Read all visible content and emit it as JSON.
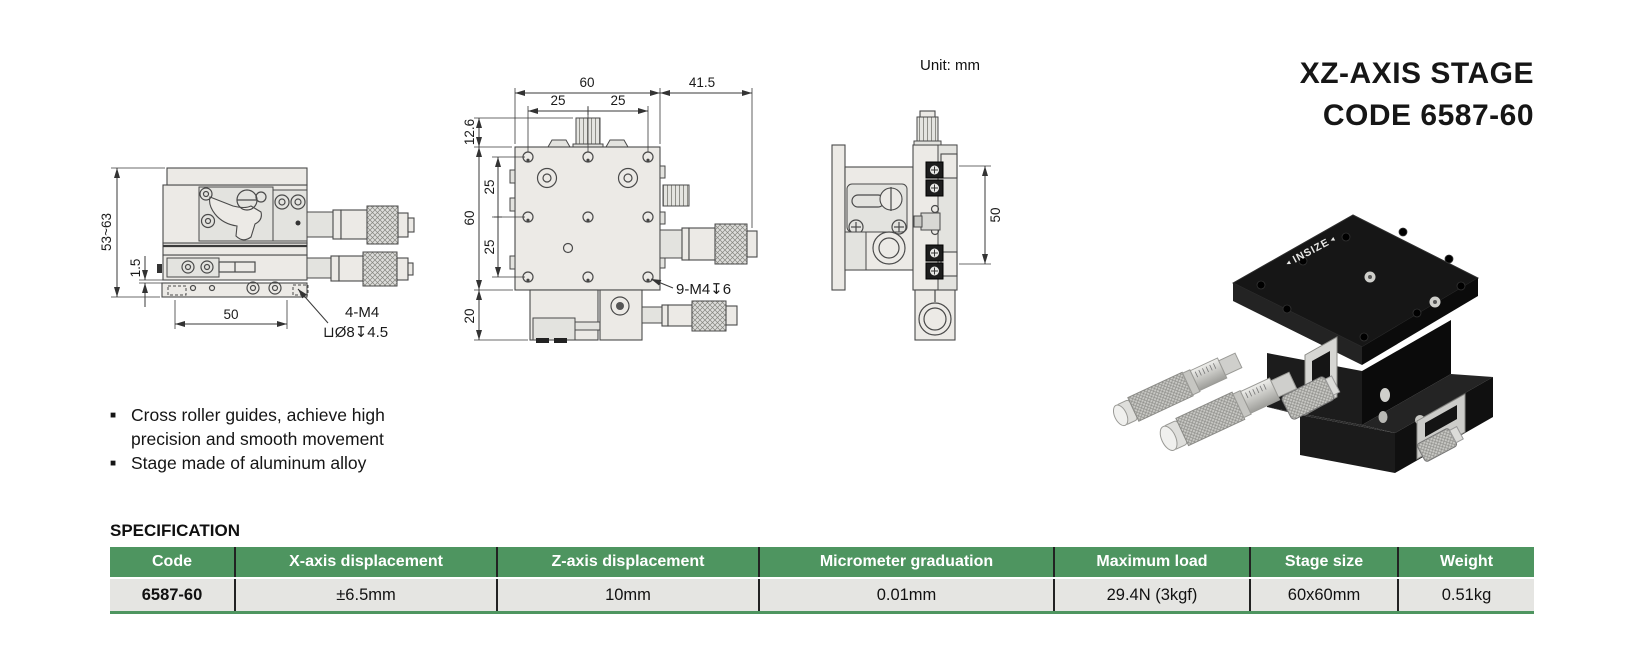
{
  "header": {
    "title_line1": "XZ-AXIS STAGE",
    "title_line2": "CODE 6587-60",
    "unit_label": "Unit: mm"
  },
  "features": {
    "bullet": "■",
    "items": [
      "Cross roller guides, achieve high precision and smooth movement",
      "Stage made of aluminum alloy"
    ]
  },
  "spec": {
    "heading": "SPECIFICATION",
    "columns": [
      "Code",
      "X-axis displacement",
      "Z-axis displacement",
      "Micrometer graduation",
      "Maximum load",
      "Stage size",
      "Weight"
    ],
    "rows": [
      [
        "6587-60",
        "±6.5mm",
        "10mm",
        "0.01mm",
        "29.4N (3kgf)",
        "60x60mm",
        "0.51kg"
      ]
    ]
  },
  "drawings": {
    "side_view": {
      "dim_height_range": "53~63",
      "dim_base_gap": "1.5",
      "dim_width": "50",
      "note_line1": "4-M4",
      "note_line2": "⊔Ø8↧4.5"
    },
    "top_view": {
      "dim_width_total": "60",
      "dim_micrometer_len": "41.5",
      "dim_pitch_left": "25",
      "dim_pitch_right": "25",
      "dim_top_offset": "12.6",
      "dim_left_pitch_upper": "25",
      "dim_left_total": "60",
      "dim_left_pitch_lower": "25",
      "dim_bottom_height": "20",
      "note_holes": "9-M4↧6"
    },
    "front_view": {
      "dim_height": "50"
    }
  },
  "product": {
    "brand": "INSIZE"
  }
}
